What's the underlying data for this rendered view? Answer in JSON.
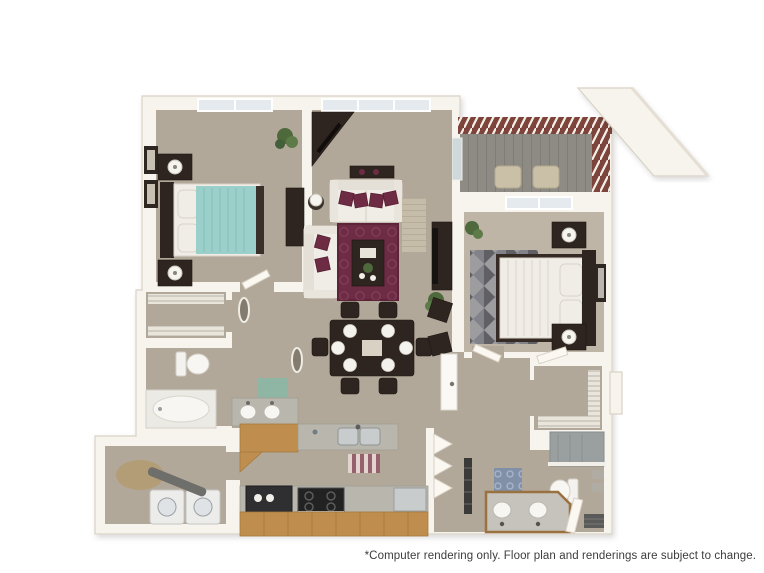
{
  "caption": {
    "text": "*Computer rendering only. Floor plan and renderings are subject to change."
  },
  "palette": {
    "background": "#ffffff",
    "wall": "#f7f4ee",
    "wall-edge": "#d8d2c6",
    "carpet": "#b2a899",
    "dark": "#2e2520",
    "wood": "#bf8e4e",
    "maroon": "#6e2b44",
    "teal": "#9bcfca",
    "deck": "#8e8b85",
    "railing": "#7c443a",
    "counter": "#b9b6ae",
    "stainless": "#c9cccd",
    "plant": "#4e6a3d",
    "white-furn": "#f0ede7",
    "gray-rug": "#9d9da0",
    "caption-color": "#3c3c3c"
  },
  "scene": {
    "type": "3d-floor-plan-top-view",
    "rooms": [
      {
        "name": "bedroom-1",
        "contents": [
          "teal-queen-bed",
          "dark-headboard",
          "two-nightstands",
          "table-lamps",
          "dresser",
          "wall-art-frames",
          "window"
        ]
      },
      {
        "name": "living-room",
        "contents": [
          "white-sofa",
          "white-loveseat",
          "maroon-accent-pillows",
          "maroon-area-rug",
          "coffee-table",
          "corner-media-cabinet",
          "console-table-with-vases",
          "tv-cabinet",
          "lamp-side-table",
          "striped-runner-rug",
          "potted-plants",
          "window"
        ]
      },
      {
        "name": "dining-area",
        "contents": [
          "dark-dining-table",
          "six-chairs",
          "white-place-settings",
          "two-accent-chairs"
        ]
      },
      {
        "name": "kitchen",
        "contents": [
          "double-sink",
          "range-stove",
          "refrigerator",
          "dishwasher",
          "wood-cabinets",
          "striped-kitchen-rug"
        ]
      },
      {
        "name": "bathroom-1",
        "contents": [
          "toilet",
          "bathtub",
          "double-sink-vanity",
          "teal-bath-mat"
        ]
      },
      {
        "name": "walk-in-closet-1",
        "contents": [
          "wire-shelving"
        ]
      },
      {
        "name": "laundry-room",
        "contents": [
          "washer",
          "dryer",
          "oval-rug",
          "ironing-board"
        ]
      },
      {
        "name": "entry-hall",
        "contents": [
          "interior-door",
          "bifold-closet-doors",
          "linen-shelves"
        ]
      },
      {
        "name": "bedroom-2",
        "contents": [
          "white-queen-bed",
          "dark-headboard",
          "two-nightstands",
          "table-lamps",
          "gray-diamond-rug",
          "wall-mirror",
          "window",
          "potted-plant"
        ]
      },
      {
        "name": "walk-in-closet-2",
        "contents": [
          "wire-shelving",
          "door"
        ]
      },
      {
        "name": "bathroom-2",
        "contents": [
          "double-vanity",
          "toilet",
          "glass-shower",
          "blue-patterned-rug",
          "dark-door-mat",
          "towel-bars"
        ]
      },
      {
        "name": "balcony",
        "contents": [
          "plank-decking",
          "red-brown-railing",
          "two-patio-chairs",
          "roof-overhang"
        ]
      }
    ]
  }
}
